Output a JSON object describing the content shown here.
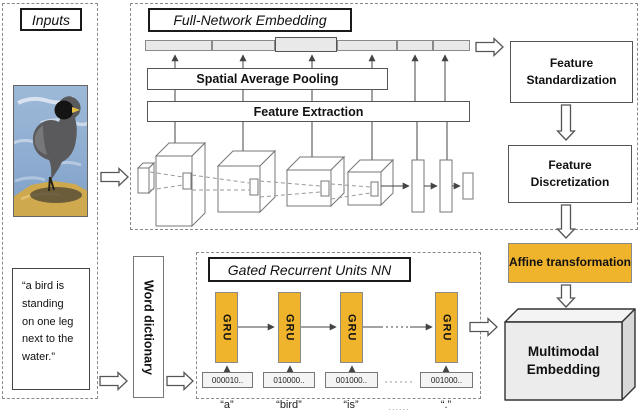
{
  "figure": {
    "inputs": {
      "title": "Inputs",
      "caption": "“a bird is\nstanding\non one leg\nnext to the\nwater.”"
    },
    "fne": {
      "title": "Full-Network Embedding",
      "pooling": "Spatial Average Pooling",
      "extraction": "Feature Extraction"
    },
    "pipeline": {
      "standardization": "Feature Standardization",
      "discretization": "Feature Discretization",
      "affine": "Affine transformation",
      "multimodal": "Multimodal Embedding"
    },
    "word_dictionary": "Word dictionary",
    "gru": {
      "title": "Gated Recurrent Units NN",
      "units": [
        "GRU",
        "GRU",
        "GRU",
        "GRU"
      ],
      "codes": [
        "000010..",
        "010000..",
        "001000..",
        "001000.."
      ],
      "words": [
        "“a”",
        "“bird”",
        "“is”",
        "“.”"
      ],
      "ellipsis": "......"
    },
    "colors": {
      "accent_orange": "#F0B32C",
      "bar_gray": "#E9E9E9",
      "box_face_gray": "#ECECEC"
    }
  }
}
